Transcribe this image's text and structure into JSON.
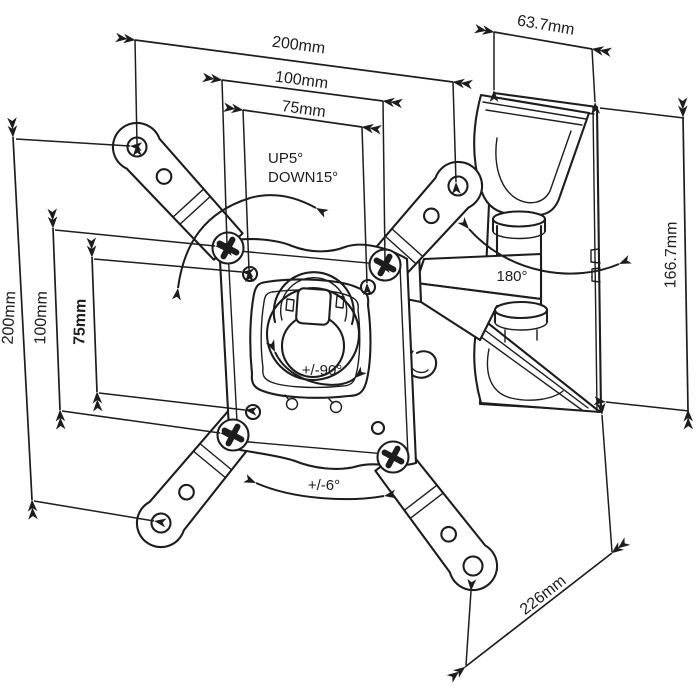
{
  "diagram": {
    "background": "#ffffff",
    "line_color": "#1d1d1d",
    "dimensions": {
      "top_outer": "200mm",
      "top_middle": "100mm",
      "top_inner": "75mm",
      "bracket_top_width": "63.7mm",
      "left_outer": "200mm",
      "left_middle": "100mm",
      "left_inner": "75mm",
      "bracket_right_height": "166.7mm",
      "arm_reach": "226mm"
    },
    "angles": {
      "tilt": {
        "up": "UP5°",
        "down": "DOWN15°"
      },
      "swivel": "180°",
      "rotation": "+/-90°",
      "post_level": "+/-6°"
    }
  }
}
